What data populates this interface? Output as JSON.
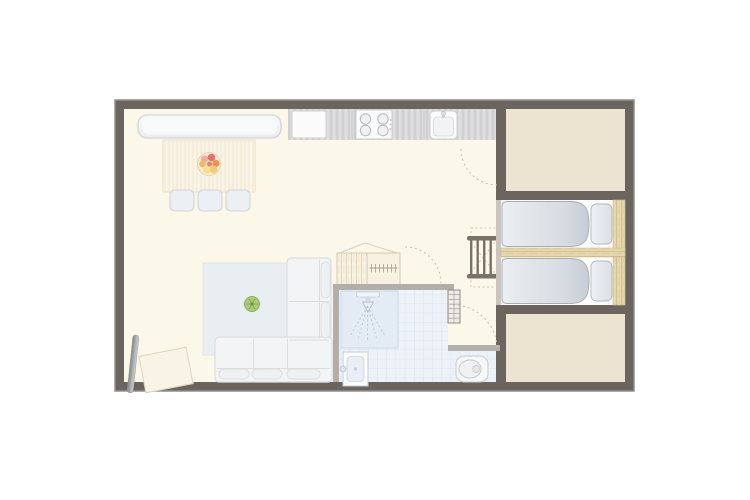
{
  "plan": {
    "kind": "architectural-floor-plan",
    "rooms": [
      {
        "name": "living-kitchen-area"
      },
      {
        "name": "bathroom"
      },
      {
        "name": "sleeping-alcove-two-beds"
      },
      {
        "name": "annex-room-top"
      },
      {
        "name": "annex-room-bottom"
      }
    ],
    "furniture": [
      "kitchen-counter",
      "cutting-board",
      "cooktop-4-burners",
      "kitchen-sink",
      "bench",
      "dining-table",
      "fruit-bowl",
      "dining-chair",
      "dining-chair",
      "dining-chair",
      "rug",
      "potted-plant",
      "corner-sofa",
      "tv",
      "side-table",
      "wardrobe",
      "shower",
      "washbasin",
      "toilet",
      "radiator",
      "bunk-ladder",
      "bed",
      "bed",
      "pillow",
      "pillow",
      "headboard-plank",
      "divider-shelf",
      "door-swing-arc",
      "door-swing-arc",
      "door-swing-arc"
    ]
  },
  "colors": {
    "background": "#ffffff",
    "wall": "#6c645f",
    "wall_outline": "#958e88",
    "interior_wall": "#b2aeaa",
    "floor_main": "#fbf7e9",
    "floor_annex": "#ece3d0",
    "niche_trim": "#c9c5c0",
    "counter": "#d8d8da",
    "appliance": "#fbfbfc",
    "bench": "#f2f4f6",
    "table_wood": "#f9f2e3",
    "seat": "#edf0f3",
    "rug": "#e9eef3",
    "sofa": "#f3f4f6",
    "plant": "#accb7e",
    "tile": "#edf2f8",
    "shower_tray": "#e3ecf4",
    "wood": "#e6d7ae",
    "mattress": "#fbfcfd",
    "pillow": "#e3e8ed",
    "duvet_light": "#ebeef2",
    "duvet_dark": "#c7cdd5",
    "ladder": "#7a7269",
    "door_arc": "#c4beb4",
    "wardrobe": "#f8f1e1",
    "radiator_frame": "#8f8b85"
  }
}
